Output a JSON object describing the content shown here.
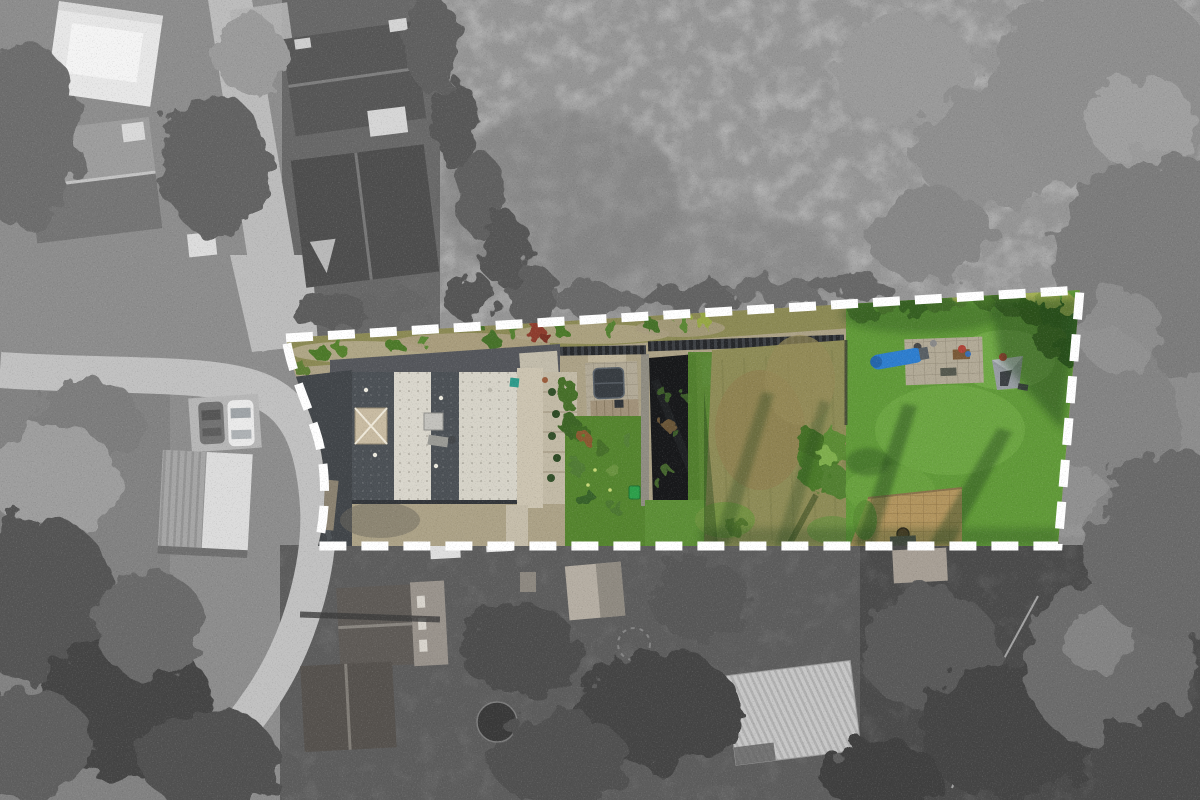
{
  "scene": {
    "type": "aerial-drone-photo-of-property",
    "highlight": "colour plot on greyscale surroundings",
    "boundary": {
      "stroke": "#ffffff",
      "style": "dashed",
      "dash": "27 15",
      "width": 9
    },
    "palette": {
      "base_gray": "#8d8d8d",
      "field_gray": "#959595",
      "garden_dark": "#5d5d5d",
      "garden_darker": "#4b4b4b",
      "bank_gray": "#828282",
      "road_gray": "#c1c1c1",
      "lane_gray": "#bcbcbc",
      "pad_gray": "#b7b7b7",
      "tree_dark": "#454545",
      "tree_mid": "#6e6e6e",
      "tree_light": "#9b9b9b",
      "white_building": "#e7e7e7",
      "neighbor_roof_dark": "#575757",
      "neighbor_roof_light": "#a6a6a6",
      "roof_slate": "#4c5156",
      "roof_white": "#d9d6cc",
      "roof_white2": "#d6d3c8",
      "skylight_tan": "#c8bba2",
      "driveway_asphalt": "#42464a",
      "gravel_tan": "#aca287",
      "concrete_light": "#ccc4b1",
      "paver_gray": "#b2aa97",
      "hot_tub_gray": "#383d42",
      "deck_wood": "#a1927a",
      "tarp_black": "#18191b",
      "wall_stone": "#908d82",
      "fence_dark": "#26282b",
      "greenhouse_glass": "#cfd8d5",
      "garden_lawn": "#55852f",
      "meadow_olive": "#8e8c57",
      "lawn_green": "#619a39",
      "lawn_bright": "#76ae4a",
      "canopy_green": "#3f6b26",
      "canopy_yellow": "#a2b254",
      "shadow_green": "#23421a",
      "slide_blue": "#2e7ecf",
      "patio_tan": "#b2955f",
      "tent_gray": "#989da3",
      "bin_green": "#2da04b",
      "bush_red": "#8e3d2e",
      "bush_rust": "#8a5a30",
      "car_white": "#eaeaea",
      "car_gray": "#737373",
      "pond_dark": "#3a3a3a"
    }
  }
}
